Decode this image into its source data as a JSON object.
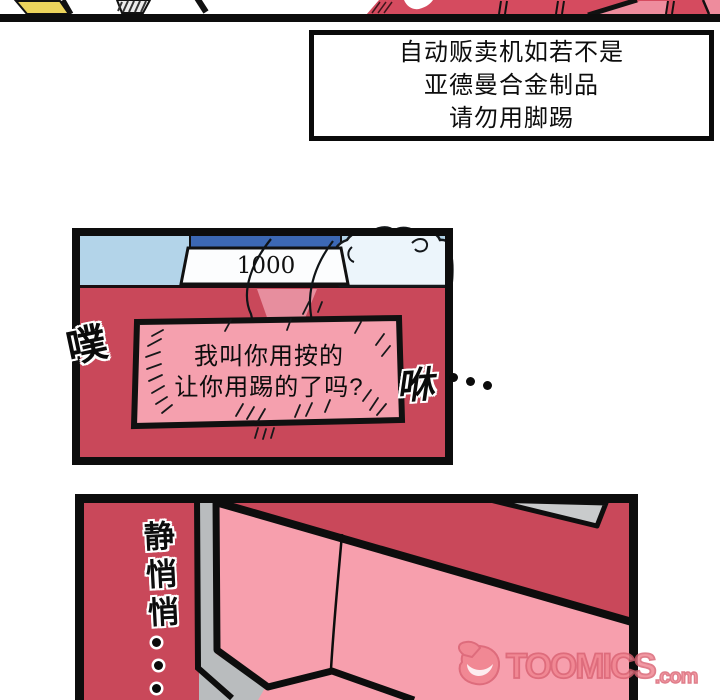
{
  "notice_box": {
    "lines": [
      "自动贩卖机如若不是",
      "亚德曼合金制品",
      "请勿用脚踢"
    ]
  },
  "vending_panel": {
    "price_display": "1000",
    "sign_lines": [
      "我叫你用按的",
      "让你用踢的了吗?"
    ],
    "sfx_left": "噗",
    "sfx_right": "咻",
    "sfx_right_dots": "···"
  },
  "quiet_panel": {
    "sfx_vertical": "静悄悄",
    "sfx_vertical_dots": "···",
    "watermark": {
      "brand": "TOOMICS",
      "tld": ".com"
    }
  },
  "colors": {
    "machine_red": "#c9485a",
    "sign_pink": "#f5a0ae",
    "surface_pink": "#f79fad",
    "sky_blue": "#b3d4e9",
    "header_blue": "#3c68b4",
    "metal_gray": "#b9bcbe",
    "accent_yellow": "#ecd45c",
    "watermark_salmon": "#f0838f"
  }
}
